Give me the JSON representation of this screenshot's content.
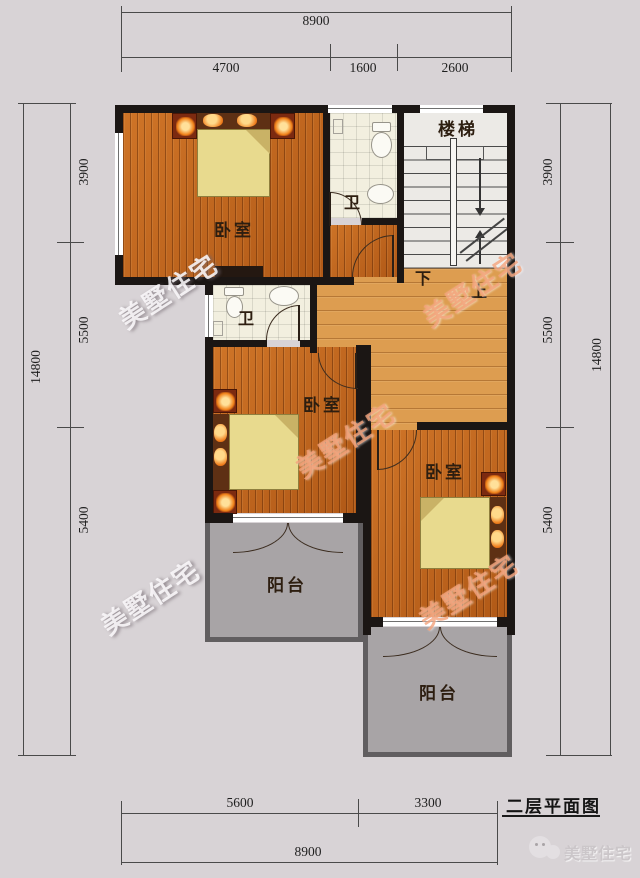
{
  "meta": {
    "bg_color": "#d8d3d6",
    "wall_color": "#1b1614",
    "floor_color": "#c4661c",
    "hall_floor_color": "#dd9d50",
    "balcony_color": "#a8a4a6",
    "bed_color": "#e8da8e"
  },
  "labels": {
    "bedroom": "卧室",
    "bathroom": "卫",
    "stairs": "楼梯",
    "balcony": "阳台",
    "stairs_down": "下",
    "stairs_up": "上"
  },
  "dimensions": {
    "top": {
      "total": "8900",
      "segments": [
        "4700",
        "1600",
        "2600"
      ]
    },
    "bottom": {
      "total": "8900",
      "segments": [
        "5600",
        "3300"
      ]
    },
    "left": {
      "total": "14800",
      "segments": [
        "3900",
        "5500",
        "5400"
      ]
    },
    "right": {
      "total": "14800",
      "segments": [
        "3900",
        "5500",
        "5400"
      ]
    }
  },
  "title_block": {
    "drawing_title": "二层平面图",
    "brand": "美墅住宅"
  },
  "watermark": {
    "text": "美墅住宅"
  }
}
